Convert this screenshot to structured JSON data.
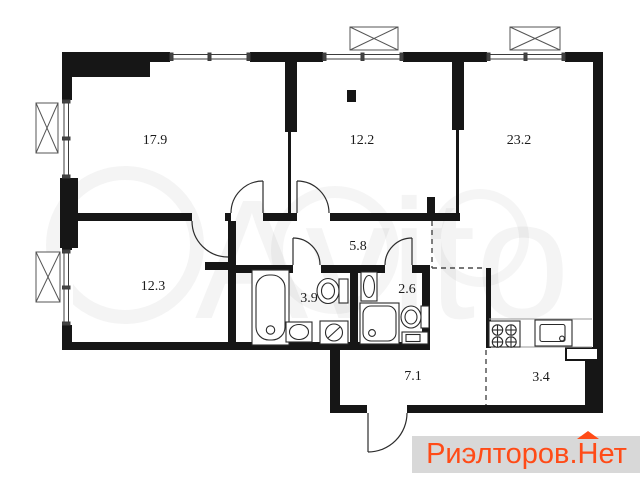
{
  "rooms": [
    {
      "name": "living-room",
      "area": "17.9"
    },
    {
      "name": "bedroom",
      "area": "12.2"
    },
    {
      "name": "kitchen-living",
      "area": "23.2"
    },
    {
      "name": "bedroom-2",
      "area": "12.3"
    },
    {
      "name": "hallway",
      "area": "5.8"
    },
    {
      "name": "bathroom",
      "area": "3.9"
    },
    {
      "name": "wc",
      "area": "2.6"
    },
    {
      "name": "corridor",
      "area": "7.1"
    },
    {
      "name": "pantry",
      "area": "3.4"
    }
  ],
  "watermark": {
    "center": "Avito",
    "brand_part1": "Риэлторов.",
    "brand_part2": "Н",
    "brand_part3": "ет"
  },
  "colors": {
    "wall": "#161616",
    "brand_text": "#ff4b17",
    "brand_bg": "#d8d8d8"
  }
}
